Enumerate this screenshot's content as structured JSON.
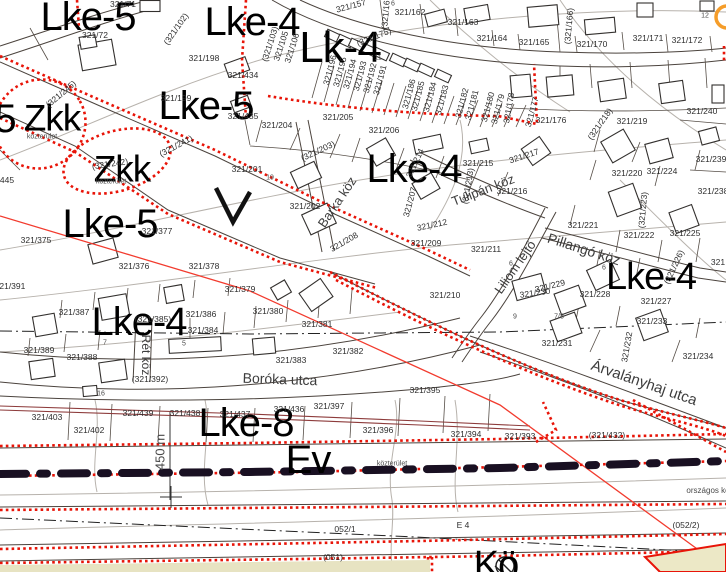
{
  "map": {
    "colors": {
      "background": "#ffffff",
      "parcel_line": "#4b433d",
      "contour_gray": "#b7b2ac",
      "boundary_red": "#e81408",
      "alignment_red": "#f23b2e",
      "road_axis_dark": "#191022",
      "maroon_line": "#8d3b3b",
      "zone_fill_cream": "#e7e3c2",
      "orange_marker": "#f59d2a",
      "label_black": "#000000"
    },
    "zone_labels": [
      {
        "t": "Lke-5",
        "x": 88,
        "y": 17,
        "s": 40
      },
      {
        "t": "Lke-4",
        "x": 252,
        "y": 22,
        "s": 40
      },
      {
        "t": "Lk-4",
        "x": 340,
        "y": 48,
        "s": 44
      },
      {
        "t": "Lke-5",
        "x": 206,
        "y": 106,
        "s": 40
      },
      {
        "t": "5",
        "x": 5,
        "y": 119,
        "s": 40
      },
      {
        "t": "Zkk",
        "x": 52,
        "y": 118,
        "s": 37
      },
      {
        "t": "Zkk",
        "x": 122,
        "y": 169,
        "s": 37
      },
      {
        "t": "Lke-5",
        "x": 110,
        "y": 224,
        "s": 40
      },
      {
        "t": "Lke-4",
        "x": 414,
        "y": 169,
        "s": 40
      },
      {
        "t": "Lke-4",
        "x": 651,
        "y": 277,
        "s": 38
      },
      {
        "t": "Lke-4",
        "x": 139,
        "y": 322,
        "s": 40
      },
      {
        "t": "Lke-8",
        "x": 246,
        "y": 423,
        "s": 40
      },
      {
        "t": "Ev",
        "x": 308,
        "y": 460,
        "s": 40
      },
      {
        "t": "Kö",
        "x": 496,
        "y": 565,
        "s": 38
      }
    ],
    "street_labels": [
      {
        "t": "Barka köz",
        "x": 337,
        "y": 202,
        "r": -56,
        "s": 13
      },
      {
        "t": "Tulipán köz",
        "x": 483,
        "y": 190,
        "r": -21,
        "s": 13
      },
      {
        "t": "Pillangó köz",
        "x": 584,
        "y": 249,
        "r": 18,
        "s": 14
      },
      {
        "t": "Liliom lejtő",
        "x": 515,
        "y": 267,
        "r": -55,
        "s": 13
      },
      {
        "t": "Rét köz",
        "x": 146,
        "y": 355,
        "r": 90,
        "s": 12
      },
      {
        "t": "Boróka utca",
        "x": 280,
        "y": 379,
        "r": 2,
        "s": 14
      },
      {
        "t": "Árvalányhaj utca",
        "x": 644,
        "y": 383,
        "r": 19,
        "s": 15
      }
    ],
    "parcel_labels": [
      {
        "t": "321/71",
        "x": 123,
        "y": 4
      },
      {
        "t": "321/72",
        "x": 95,
        "y": 35
      },
      {
        "t": "(321/102)",
        "x": 176,
        "y": 29,
        "r": -55
      },
      {
        "t": "321/198",
        "x": 204,
        "y": 58
      },
      {
        "t": "321/199",
        "x": 176,
        "y": 98
      },
      {
        "t": "321/434",
        "x": 243,
        "y": 75
      },
      {
        "t": "321/435",
        "x": 243,
        "y": 116
      },
      {
        "t": "321/157",
        "x": 351,
        "y": 6,
        "r": -15
      },
      {
        "t": "(321/161)",
        "x": 386,
        "y": 11,
        "r": -85
      },
      {
        "t": "321/162",
        "x": 410,
        "y": 12
      },
      {
        "t": "321/163",
        "x": 463,
        "y": 22
      },
      {
        "t": "321/164",
        "x": 492,
        "y": 38
      },
      {
        "t": "321/165",
        "x": 534,
        "y": 42
      },
      {
        "t": "(321/166)",
        "x": 569,
        "y": 26,
        "r": -85
      },
      {
        "t": "321/170",
        "x": 592,
        "y": 44
      },
      {
        "t": "321/171",
        "x": 648,
        "y": 38
      },
      {
        "t": "321/172",
        "x": 687,
        "y": 40
      },
      {
        "t": "(321/175)",
        "x": 374,
        "y": 37,
        "r": -22
      },
      {
        "t": "321/240",
        "x": 702,
        "y": 111
      },
      {
        "t": "(321/103)",
        "x": 270,
        "y": 44,
        "r": -72
      },
      {
        "t": "321/105",
        "x": 281,
        "y": 46,
        "r": -72
      },
      {
        "t": "321/106",
        "x": 292,
        "y": 48,
        "r": -72
      },
      {
        "t": "321/196",
        "x": 330,
        "y": 70,
        "r": -75
      },
      {
        "t": "321/195",
        "x": 340,
        "y": 72,
        "r": -75
      },
      {
        "t": "321/194",
        "x": 350,
        "y": 74,
        "r": -75
      },
      {
        "t": "321/193",
        "x": 360,
        "y": 76,
        "r": -75
      },
      {
        "t": "321/192",
        "x": 370,
        "y": 78,
        "r": -75
      },
      {
        "t": "321/191",
        "x": 380,
        "y": 80,
        "r": -75
      },
      {
        "t": "321/186",
        "x": 409,
        "y": 94,
        "r": -75
      },
      {
        "t": "321/185",
        "x": 418,
        "y": 96,
        "r": -75
      },
      {
        "t": "321/184",
        "x": 430,
        "y": 97,
        "r": -75
      },
      {
        "t": "321/183",
        "x": 442,
        "y": 100,
        "r": -75
      },
      {
        "t": "321/182",
        "x": 462,
        "y": 103,
        "r": -75
      },
      {
        "t": "321/181",
        "x": 472,
        "y": 105,
        "r": -75
      },
      {
        "t": "321/180",
        "x": 488,
        "y": 107,
        "r": -75
      },
      {
        "t": "321/179",
        "x": 498,
        "y": 109,
        "r": -75
      },
      {
        "t": "321/178",
        "x": 509,
        "y": 108,
        "r": -80
      },
      {
        "t": "321/177",
        "x": 532,
        "y": 112,
        "r": -75
      },
      {
        "t": "321/176",
        "x": 551,
        "y": 120
      },
      {
        "t": "(321/218)",
        "x": 600,
        "y": 124,
        "r": -55
      },
      {
        "t": "321/219",
        "x": 632,
        "y": 121
      },
      {
        "t": "321/217",
        "x": 524,
        "y": 156,
        "r": -18
      },
      {
        "t": "321/216",
        "x": 512,
        "y": 191
      },
      {
        "t": "321/220",
        "x": 627,
        "y": 173
      },
      {
        "t": "321/224",
        "x": 662,
        "y": 171
      },
      {
        "t": "321/239",
        "x": 711,
        "y": 159
      },
      {
        "t": "321/238",
        "x": 713,
        "y": 191
      },
      {
        "t": "(321/223)",
        "x": 643,
        "y": 210,
        "r": -85
      },
      {
        "t": "321/221",
        "x": 583,
        "y": 225
      },
      {
        "t": "321/222",
        "x": 639,
        "y": 235
      },
      {
        "t": "321/225",
        "x": 685,
        "y": 233
      },
      {
        "t": "(321/226)",
        "x": 674,
        "y": 267,
        "r": -65
      },
      {
        "t": "321",
        "x": 718,
        "y": 262
      },
      {
        "t": "321/204",
        "x": 277,
        "y": 125
      },
      {
        "t": "321/205",
        "x": 338,
        "y": 117
      },
      {
        "t": "321/206",
        "x": 384,
        "y": 130
      },
      {
        "t": "(321/203)",
        "x": 318,
        "y": 151,
        "r": -25
      },
      {
        "t": "321/201",
        "x": 247,
        "y": 169
      },
      {
        "t": "321/202",
        "x": 305,
        "y": 206
      },
      {
        "t": "321/214",
        "x": 415,
        "y": 163,
        "r": -65
      },
      {
        "t": "321/215",
        "x": 478,
        "y": 163
      },
      {
        "t": "(321/213)",
        "x": 468,
        "y": 186,
        "r": -80
      },
      {
        "t": "321/207",
        "x": 410,
        "y": 202,
        "r": -75
      },
      {
        "t": "321/212",
        "x": 432,
        "y": 225,
        "r": -12
      },
      {
        "t": "321/208",
        "x": 344,
        "y": 242,
        "r": -30
      },
      {
        "t": "321/209",
        "x": 426,
        "y": 243
      },
      {
        "t": "321/211",
        "x": 486,
        "y": 249
      },
      {
        "t": "321/210",
        "x": 445,
        "y": 295
      },
      {
        "t": "(321/245)",
        "x": 61,
        "y": 94,
        "r": -40
      },
      {
        "t": "(321/241)",
        "x": 176,
        "y": 146,
        "r": -28
      },
      {
        "t": "(321/242)",
        "x": 110,
        "y": 164,
        "r": -8
      },
      {
        "t": "445",
        "x": 7,
        "y": 180
      },
      {
        "t": "321/375",
        "x": 36,
        "y": 240
      },
      {
        "t": "321/377",
        "x": 157,
        "y": 231
      },
      {
        "t": "321/376",
        "x": 134,
        "y": 266
      },
      {
        "t": "321/378",
        "x": 204,
        "y": 266
      },
      {
        "t": "321/391",
        "x": 10,
        "y": 286
      },
      {
        "t": "321/379",
        "x": 240,
        "y": 289
      },
      {
        "t": "321/387",
        "x": 74,
        "y": 312
      },
      {
        "t": "(321/385)",
        "x": 153,
        "y": 319
      },
      {
        "t": "321/386",
        "x": 201,
        "y": 314
      },
      {
        "t": "321/384",
        "x": 203,
        "y": 330
      },
      {
        "t": "321/389",
        "x": 39,
        "y": 350
      },
      {
        "t": "321/388",
        "x": 82,
        "y": 357
      },
      {
        "t": "(321/392)",
        "x": 150,
        "y": 379
      },
      {
        "t": "321/380",
        "x": 268,
        "y": 311
      },
      {
        "t": "321/381",
        "x": 317,
        "y": 324
      },
      {
        "t": "321/382",
        "x": 348,
        "y": 351
      },
      {
        "t": "321/383",
        "x": 291,
        "y": 360
      },
      {
        "t": "321/395",
        "x": 425,
        "y": 390
      },
      {
        "t": "321/403",
        "x": 47,
        "y": 417
      },
      {
        "t": "321/402",
        "x": 89,
        "y": 430
      },
      {
        "t": "321/439",
        "x": 138,
        "y": 413
      },
      {
        "t": "321/438",
        "x": 185,
        "y": 413
      },
      {
        "t": "321/437",
        "x": 235,
        "y": 414
      },
      {
        "t": "321/436",
        "x": 289,
        "y": 409
      },
      {
        "t": "321/397",
        "x": 329,
        "y": 406
      },
      {
        "t": "321/396",
        "x": 378,
        "y": 430
      },
      {
        "t": "321/394",
        "x": 466,
        "y": 434
      },
      {
        "t": "321/393",
        "x": 520,
        "y": 436
      },
      {
        "t": "(321/432)",
        "x": 607,
        "y": 435
      },
      {
        "t": "321/228",
        "x": 595,
        "y": 294
      },
      {
        "t": "321/227",
        "x": 656,
        "y": 301
      },
      {
        "t": "321/229",
        "x": 550,
        "y": 286,
        "r": -14
      },
      {
        "t": "321/230",
        "x": 535,
        "y": 293,
        "r": -8
      },
      {
        "t": "321/231",
        "x": 557,
        "y": 343
      },
      {
        "t": "321/232",
        "x": 627,
        "y": 347,
        "r": -80
      },
      {
        "t": "321/233",
        "x": 652,
        "y": 321
      },
      {
        "t": "321/234",
        "x": 698,
        "y": 356
      },
      {
        "t": "052/1",
        "x": 345,
        "y": 529
      },
      {
        "t": "E 4",
        "x": 463,
        "y": 525
      },
      {
        "t": "(052/2)",
        "x": 686,
        "y": 525
      },
      {
        "t": "(051)",
        "x": 333,
        "y": 557
      }
    ],
    "small_labels": [
      {
        "t": "közterület",
        "x": 42,
        "y": 137
      },
      {
        "t": "közterület",
        "x": 111,
        "y": 182
      },
      {
        "t": "közterület",
        "x": 392,
        "y": 464
      },
      {
        "t": "országos kö",
        "x": 708,
        "y": 491,
        "s": 8
      },
      {
        "t": "450 m",
        "x": 160,
        "y": 452,
        "r": -90,
        "s": 13
      },
      {
        "t": "12",
        "x": 705,
        "y": 16
      },
      {
        "t": "6",
        "x": 393,
        "y": 4
      },
      {
        "t": "19",
        "x": 270,
        "y": 178
      },
      {
        "t": "11",
        "x": 378,
        "y": 58
      },
      {
        "t": "7",
        "x": 105,
        "y": 343
      },
      {
        "t": "5",
        "x": 184,
        "y": 344
      },
      {
        "t": "16",
        "x": 101,
        "y": 394
      },
      {
        "t": "9",
        "x": 515,
        "y": 317
      },
      {
        "t": "7/8",
        "x": 559,
        "y": 317
      },
      {
        "t": "6",
        "x": 511,
        "y": 264
      },
      {
        "t": "6",
        "x": 604,
        "y": 268
      }
    ]
  }
}
